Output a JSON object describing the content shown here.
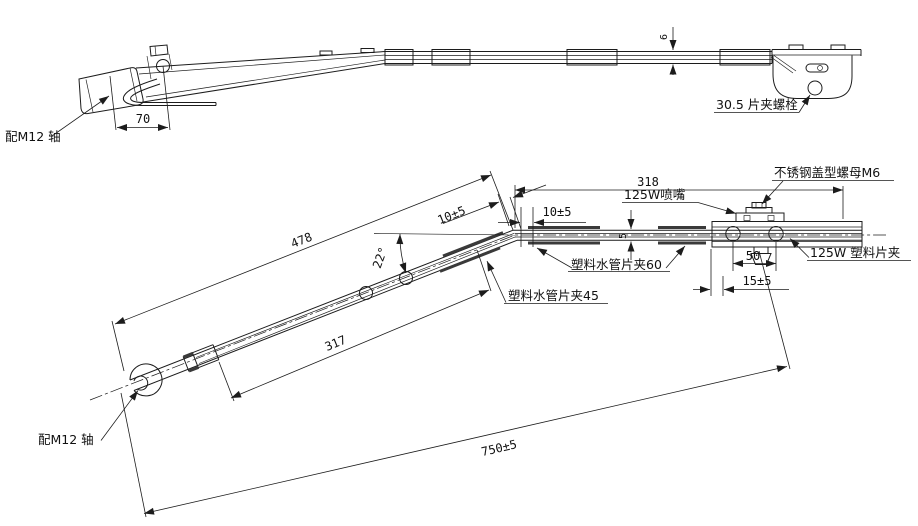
{
  "drawing": {
    "line_color": "#1c1c1c",
    "background": "#ffffff",
    "top": {
      "axis_label": "配M12 轴",
      "dim_70": "70",
      "dim_6": "6",
      "bolt_label": "30.5 片夹螺栓"
    },
    "front": {
      "axis_label": "配M12 轴",
      "dim_478": "478",
      "dim_317": "317",
      "dim_750": "750±5",
      "dim_318": "318",
      "dim_10_slope": "10±5",
      "dim_10_horiz": "10±5",
      "dim_angle": "22°",
      "dim_5": "5",
      "dim_50": "50",
      "dim_15": "15±5",
      "nozzle_label": "125W喷嘴",
      "cap_nut_label": "不锈钢盖型螺母M6",
      "clip_label": "125W 塑料片夹",
      "hose_clip_60_label": "塑料水管片夹60",
      "hose_clip_45_label": "塑料水管片夹45"
    }
  }
}
